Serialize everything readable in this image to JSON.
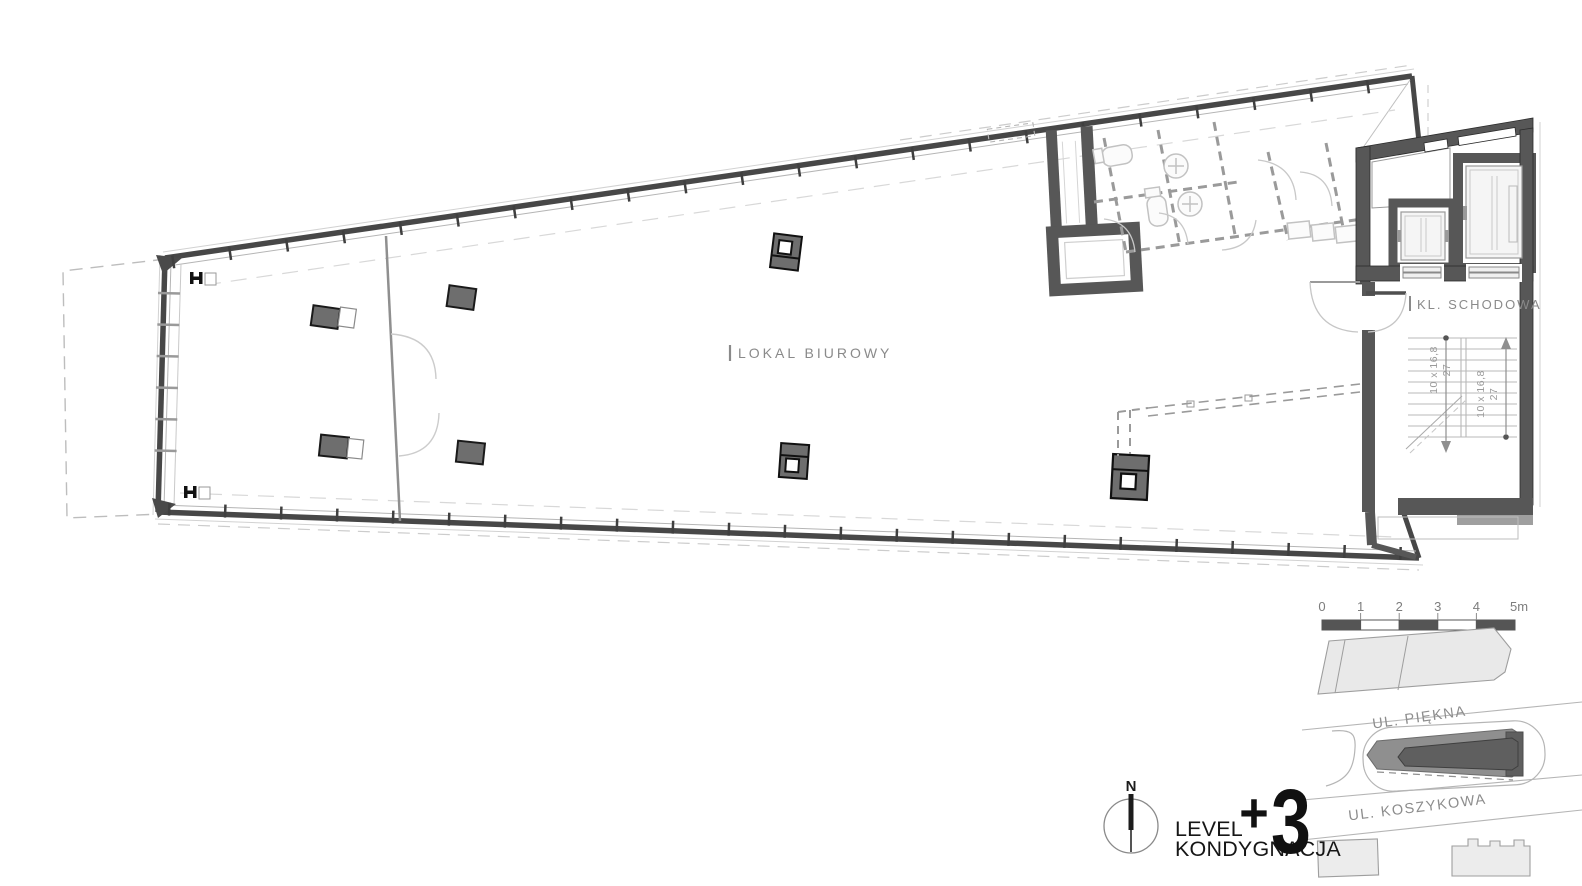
{
  "plan": {
    "office_label": "LOKAL BIUROWY",
    "stair_room_label": "KL. SCHODOWA",
    "stairs": {
      "flight1": {
        "riser_dim": "10 x 16,8",
        "tread_dim": "27"
      },
      "flight2": {
        "riser_dim": "10 x 16,8",
        "tread_dim": "27"
      }
    }
  },
  "scale_bar": {
    "labels": [
      "0",
      "1",
      "2",
      "3",
      "4",
      "5m"
    ]
  },
  "site_map": {
    "street_top_label": "UL. PIĘKNA",
    "street_bottom_label": "UL. KOSZYKOWA"
  },
  "title_block": {
    "north_label": "N",
    "level_word_line1": "LEVEL",
    "level_word_line2": "KONDYGNACJA",
    "level_value_plus": "+",
    "level_value_digit": "3"
  },
  "colors": {
    "wall_dark": "#575757",
    "facade": "#474747",
    "column": "#6e6e6e",
    "light_line": "#c4c4c4",
    "text_gray": "#8a8a8a",
    "site_building_light": "#e9e9e9",
    "site_building_mid": "#8f8f8f",
    "site_building_dark": "#5f5f5f"
  }
}
